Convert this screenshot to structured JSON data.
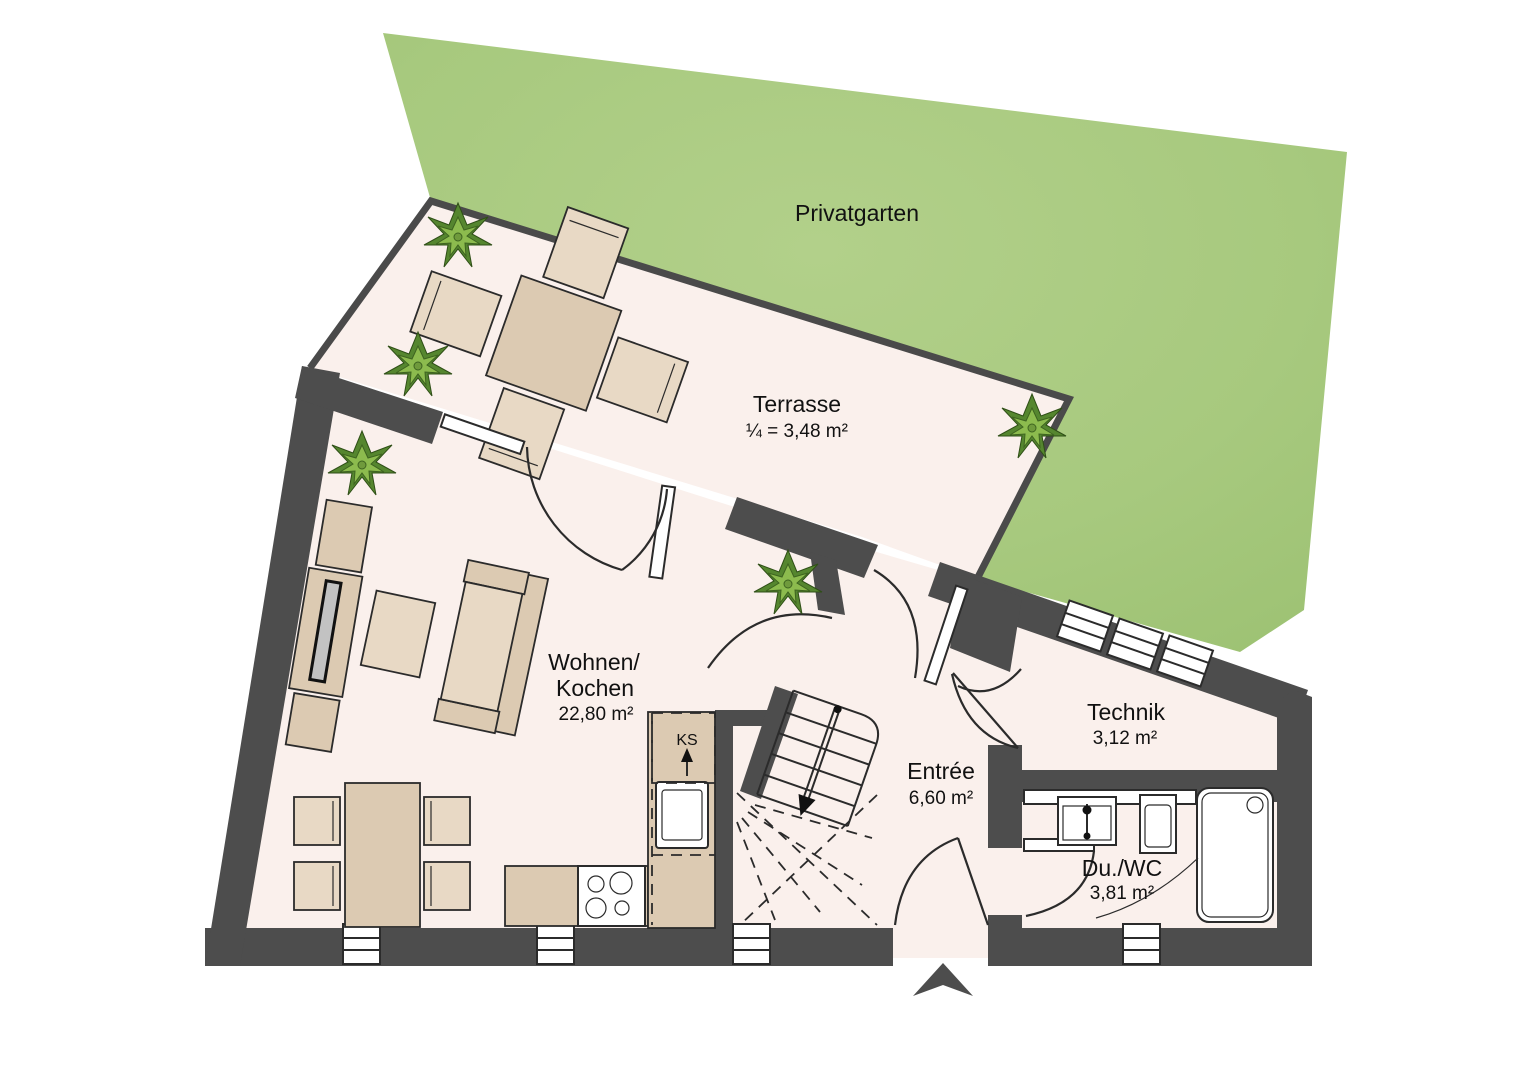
{
  "plan": {
    "garden": {
      "label": "Privatgarten"
    },
    "rooms": [
      {
        "id": "terrasse",
        "name": "Terrasse",
        "area": "¼ = 3,48 m²"
      },
      {
        "id": "wohnen-kochen",
        "name_line1": "Wohnen/",
        "name_line2": "Kochen",
        "area": "22,80 m²"
      },
      {
        "id": "entree",
        "name": "Entrée",
        "area": "6,60 m²"
      },
      {
        "id": "technik",
        "name": "Technik",
        "area": "3,12 m²"
      },
      {
        "id": "du-wc",
        "name": "Du./WC",
        "area": "3,81 m²"
      }
    ],
    "kitchen": {
      "fridge_label": "KS"
    },
    "colors": {
      "garden": "#a7c97e",
      "floor": "#faf0ec",
      "wall": "#4d4d4d",
      "furniture": "#dccab2",
      "furniture-light": "#e8d9c5",
      "outline": "#2b2b2b",
      "plant-dark": "#55862f",
      "plant-light": "#8cbb4e"
    }
  }
}
